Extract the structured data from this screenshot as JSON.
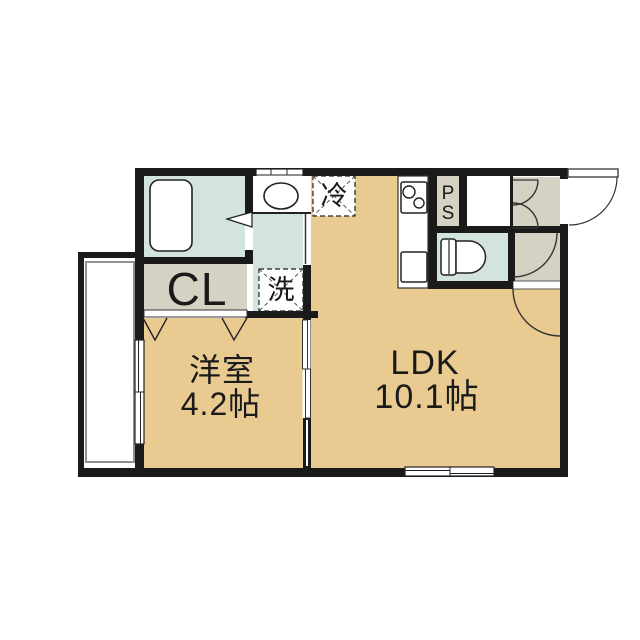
{
  "plan": {
    "type": "apartment-floor-plan",
    "labels": {
      "western_room": "洋室",
      "western_room_size": "4.2帖",
      "ldk": "LDK",
      "ldk_size": "10.1帖",
      "closet": "CL",
      "laundry": "洗",
      "refrigerator": "冷",
      "pipe_space_p": "P",
      "pipe_space_s": "S"
    },
    "colors": {
      "wall": "#1a1a1a",
      "room_floor_tan": "#e9cb92",
      "wet_area_mint": "#d3e3de",
      "service_gray": "#d5d1c3",
      "fixture_white": "#ffffff",
      "outline": "#222222",
      "balcony_inner_line": "#909090"
    }
  }
}
